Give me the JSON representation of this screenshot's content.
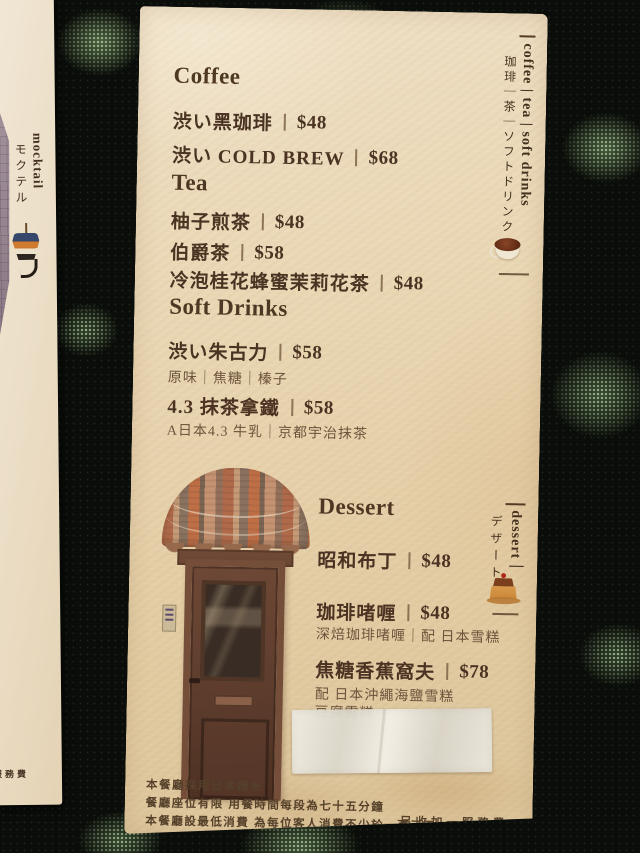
{
  "scene": {
    "table_base_color": "#0a0d09",
    "speckle_color": "#9fcf93",
    "card_color": "#e9d6b2",
    "ink_color": "#4a3322"
  },
  "left_card": {
    "label_en": "mocktail",
    "label_jp": "モクテル",
    "icon": "mocktail-glass-icon",
    "footer_partial": "服務費"
  },
  "card": {
    "drinks": {
      "side_en": "coffee | tea | soft drinks",
      "side_jp": "珈琲｜茶｜ソフトドリンク",
      "side_icon": "coffee-cup-icon",
      "coffee": {
        "heading": "Coffee",
        "items": [
          {
            "name": "渋い黑珈琲",
            "price": "$48"
          },
          {
            "name": "渋い COLD BREW",
            "price": "$68"
          }
        ]
      },
      "tea": {
        "heading": "Tea",
        "items": [
          {
            "name": "柚子煎茶",
            "price": "$48"
          },
          {
            "name": "伯爵茶",
            "price": "$58"
          },
          {
            "name": "冷泡桂花蜂蜜茉莉花茶",
            "price": "$48"
          }
        ]
      },
      "soft_drinks": {
        "heading": "Soft Drinks",
        "items": [
          {
            "name": "渋い朱古力",
            "price": "$58",
            "note": "原味｜焦糖｜榛子"
          },
          {
            "name": "4.3 抹茶拿鐵",
            "price": "$58",
            "note": "A日本4.3 牛乳｜京都宇治抹茶"
          }
        ]
      }
    },
    "dessert": {
      "heading": "Dessert",
      "side_en": "dessert｜",
      "side_jp": "デザート",
      "side_icon": "pudding-icon",
      "items": [
        {
          "name": "昭和布丁",
          "price": "$48"
        },
        {
          "name": "珈琲啫喱",
          "price": "$48",
          "note": "深焙珈琲啫喱｜配 日本雪糕"
        },
        {
          "name": "焦糖香蕉窩夫",
          "price": "$78",
          "note": "配 日本沖繩海鹽雪糕",
          "note2": "豆腐雪糕"
        }
      ]
    },
    "footer": {
      "line1": "本餐廳採用日本精米",
      "line2": "餐廳座位有限 用餐時間每段為七十五分鐘",
      "line3": "本餐廳設最低消費 為每位客人消費不少於一百元正",
      "service": "另收加一服務費"
    }
  }
}
